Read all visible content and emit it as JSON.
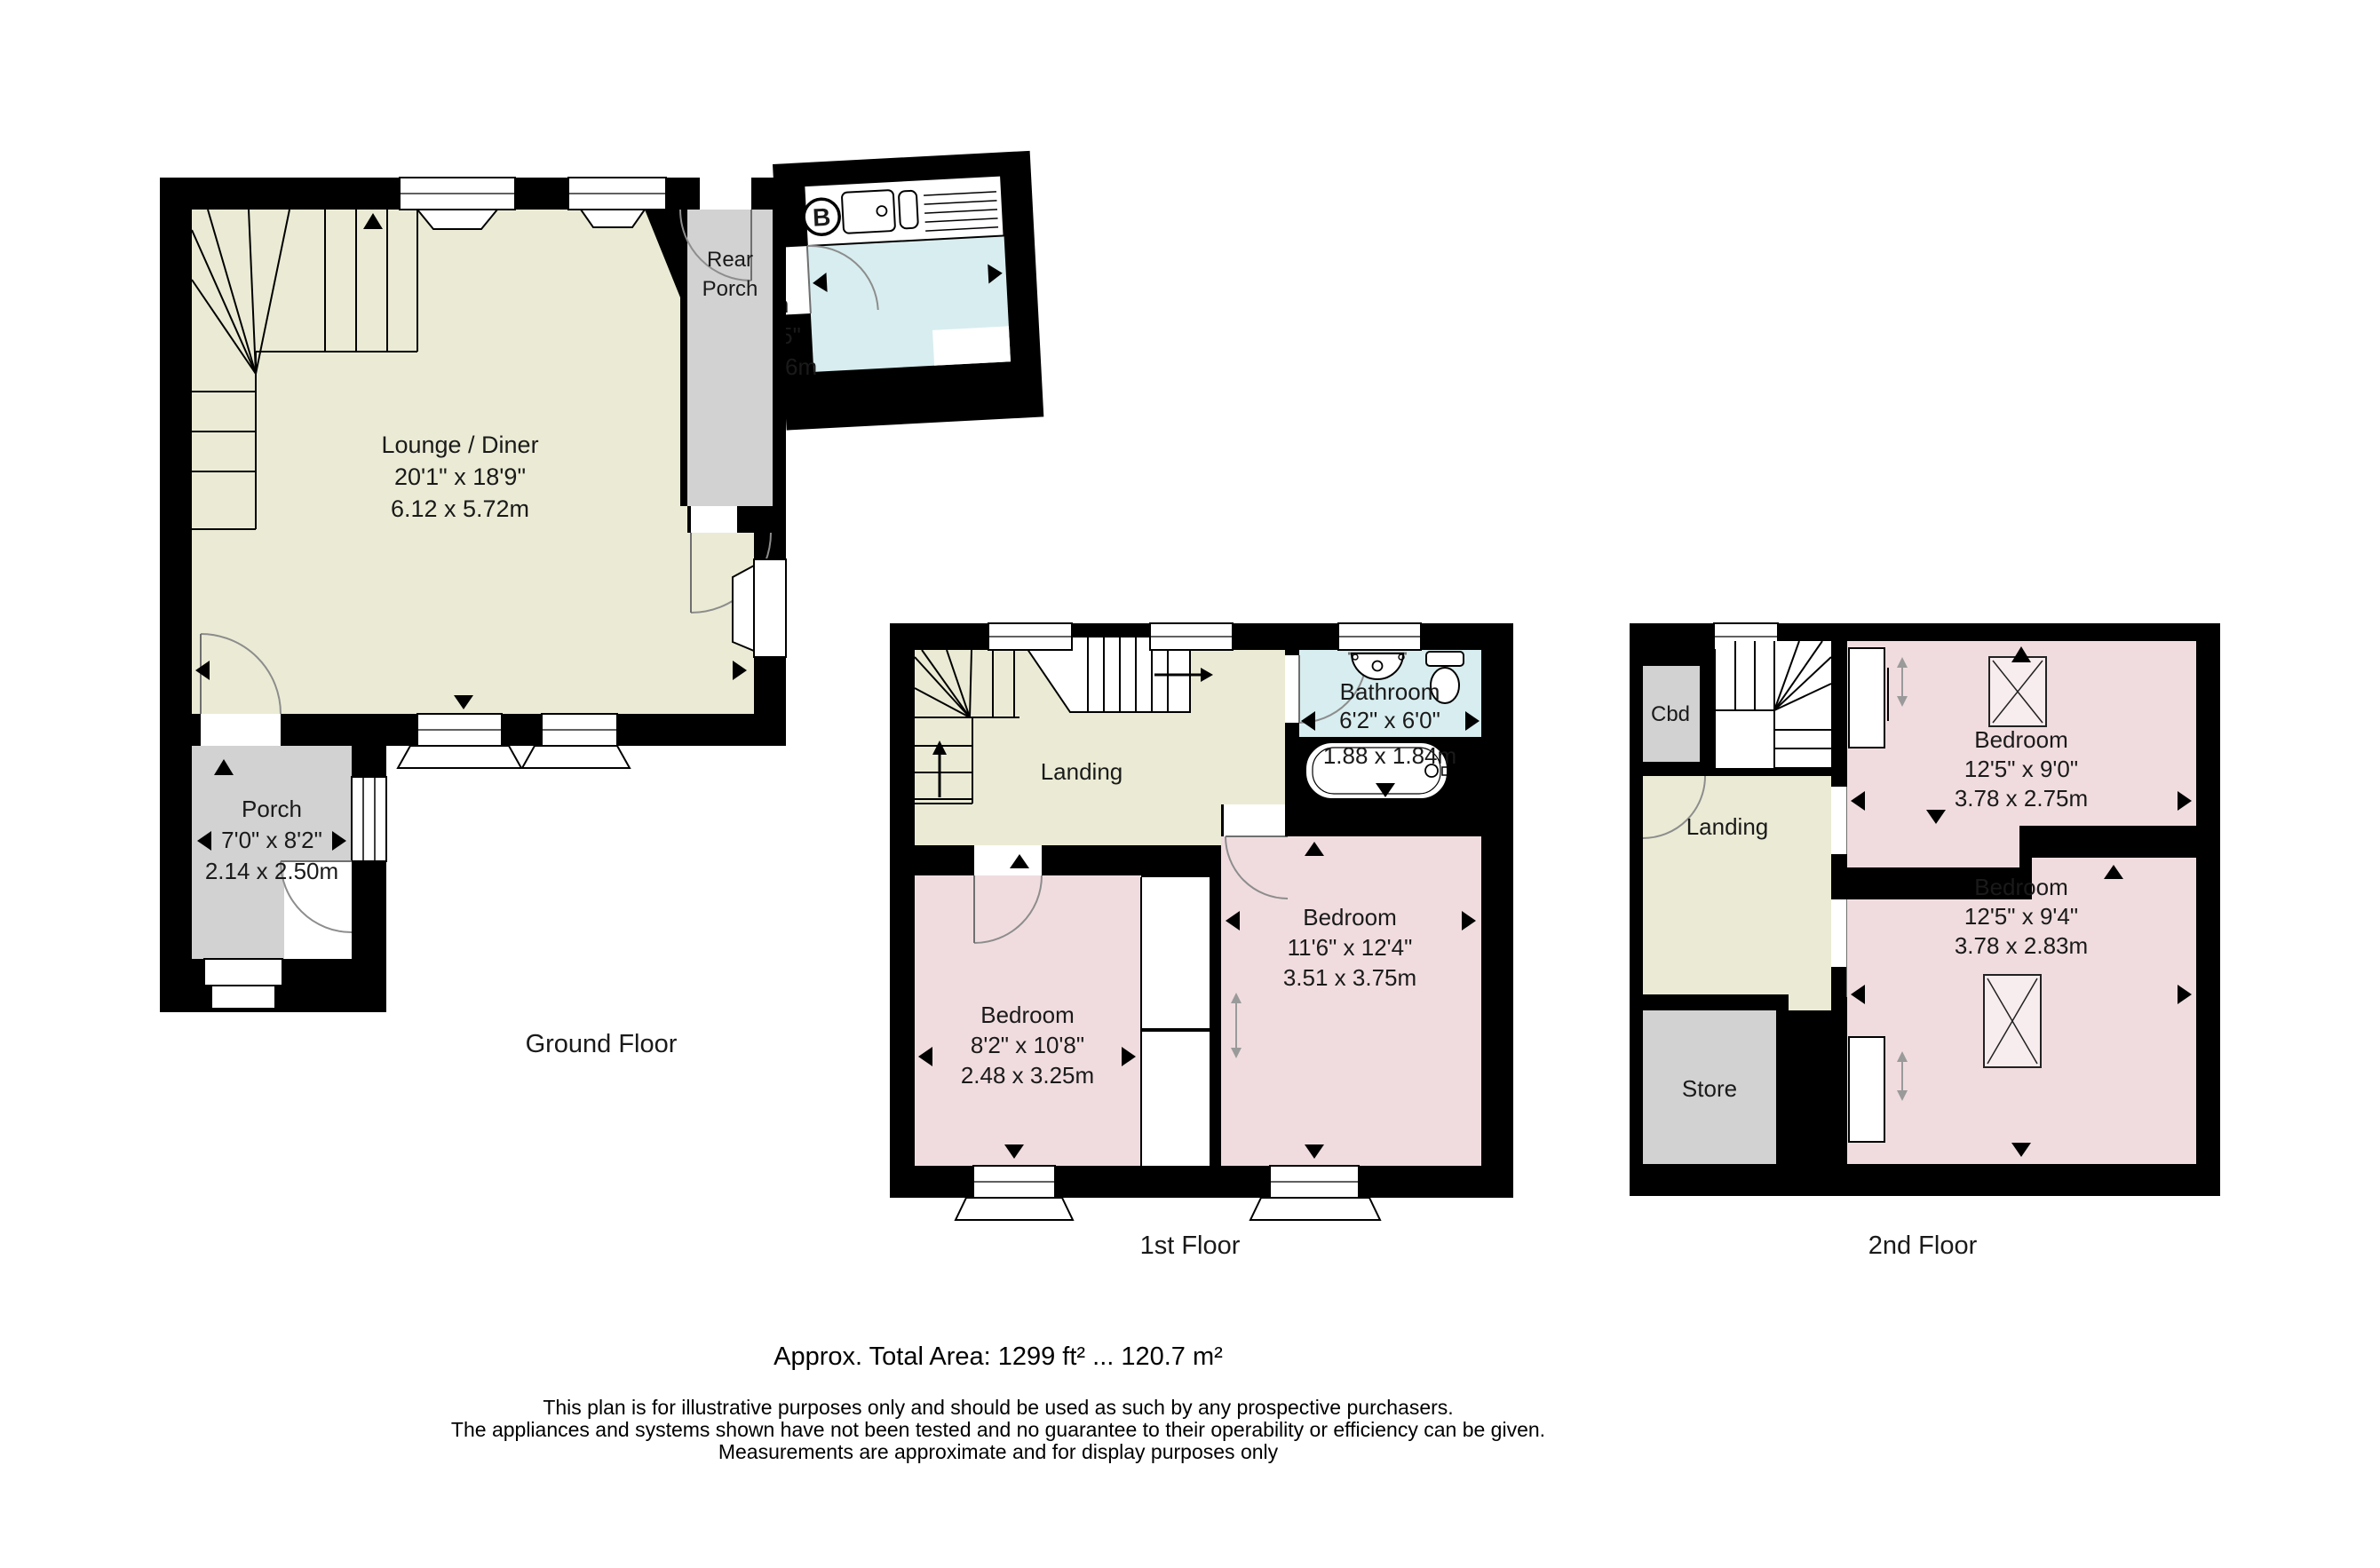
{
  "document": {
    "type": "estate-agent floor plan",
    "background": "#ffffff"
  },
  "colors": {
    "wall": "#000000",
    "room_cream": "#ebebd5",
    "room_blue": "#d8edef",
    "room_pink": "#f0dcdf",
    "room_gray": "#d2d2d2",
    "skylight_fill": "#f7ecee",
    "door_arc": "#8d8d8d"
  },
  "floors": [
    {
      "id": "ground",
      "title": "Ground Floor",
      "boiler_label": "B",
      "rooms": [
        {
          "key": "lounge_diner",
          "name": "Lounge / Diner",
          "imperial": "20'1\" x 18'9\"",
          "metric": "6.12 x 5.72m"
        },
        {
          "key": "kitchen",
          "name": "Kitchen",
          "imperial": "8'0\" x 8'5\"",
          "metric": "2.45 x 2.56m"
        },
        {
          "key": "rear_porch",
          "name_line1": "Rear",
          "name_line2": "Porch"
        },
        {
          "key": "porch",
          "name": "Porch",
          "imperial": "7'0\" x 8'2\"",
          "metric": "2.14 x 2.50m"
        }
      ]
    },
    {
      "id": "first",
      "title": "1st Floor",
      "rooms": [
        {
          "key": "landing",
          "name": "Landing"
        },
        {
          "key": "bathroom",
          "name": "Bathroom",
          "imperial": "6'2\" x 6'0\"",
          "metric": "1.88 x 1.84m"
        },
        {
          "key": "bedroom_left",
          "name": "Bedroom",
          "imperial": "8'2\" x 10'8\"",
          "metric": "2.48 x 3.25m"
        },
        {
          "key": "bedroom_right",
          "name": "Bedroom",
          "imperial": "11'6\" x 12'4\"",
          "metric": "3.51 x 3.75m"
        }
      ]
    },
    {
      "id": "second",
      "title": "2nd Floor",
      "rooms": [
        {
          "key": "cbd",
          "name": "Cbd"
        },
        {
          "key": "landing",
          "name": "Landing"
        },
        {
          "key": "store",
          "name": "Store"
        },
        {
          "key": "bedroom_top",
          "name": "Bedroom",
          "imperial": "12'5\" x 9'0\"",
          "metric": "3.78 x 2.75m"
        },
        {
          "key": "bedroom_bottom",
          "name": "Bedroom",
          "imperial": "12'5\" x 9'4\"",
          "metric": "3.78 x 2.83m"
        }
      ]
    }
  ],
  "footer": {
    "total_area": "Approx. Total Area: 1299 ft² ... 120.7 m²",
    "disclaimer_lines": [
      "This plan is for illustrative purposes only and should be used as such by any prospective purchasers.",
      "The appliances and systems shown have not been tested and no guarantee to their operability or efficiency can be given.",
      "Measurements are approximate and for display purposes only"
    ]
  }
}
